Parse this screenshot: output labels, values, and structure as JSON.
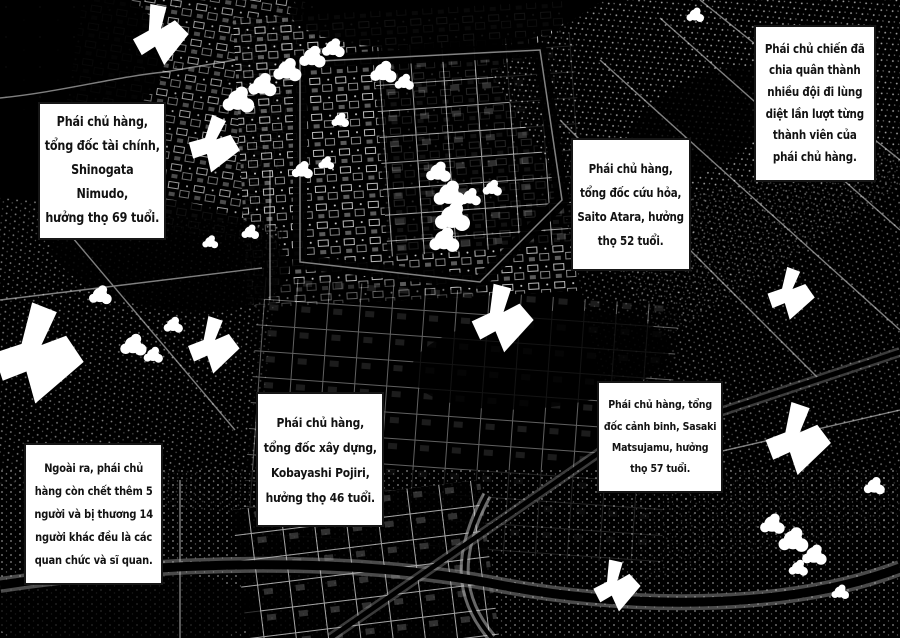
{
  "page": {
    "kind": "manga aerial-bombardment spread",
    "background_color": "#000000",
    "caption_background": "#ffffff",
    "caption_border_color": "#161616",
    "caption_text_color": "#121212",
    "ink_white": "#ffffff"
  },
  "captions": [
    {
      "id": "finance-minister",
      "text": "Phái chủ hàng,\ntổng đốc tài chính,\nShinogata Nimudo,\nhưởng thọ 69 tuổi."
    },
    {
      "id": "war-faction-hunt",
      "text": "Phái chủ chiến đã\nchia quân thành\nnhiều đội đi lùng\ndiệt lần lượt từng\nthành viên của\nphái chủ hàng."
    },
    {
      "id": "fire-chief",
      "text": "Phái chủ hàng,\ntổng đốc cứu hỏa,\nSaito Atara, hưởng\nthọ 52 tuổi."
    },
    {
      "id": "construction-chief",
      "text": "Phái chủ hàng,\ntổng đốc xây dựng,\nKobayashi Pojiri,\nhưởng thọ 46 tuổi."
    },
    {
      "id": "police-chief",
      "text": "Phái chủ hàng, tổng\nđốc cảnh binh, Sasaki\nMatsujamu, hưởng\nthọ 57 tuổi."
    },
    {
      "id": "additional-casualties",
      "text": "Ngoài ra, phái chủ\nhàng còn chết thêm 5\nngười và bị thương 14\nngười khác đều là các\nquan chức và sĩ quan."
    }
  ],
  "icons": {
    "attack_arrow": "attack-arrow-icon",
    "smoke_cloud": "smoke-cloud",
    "map_art": "aerial-city-map"
  }
}
